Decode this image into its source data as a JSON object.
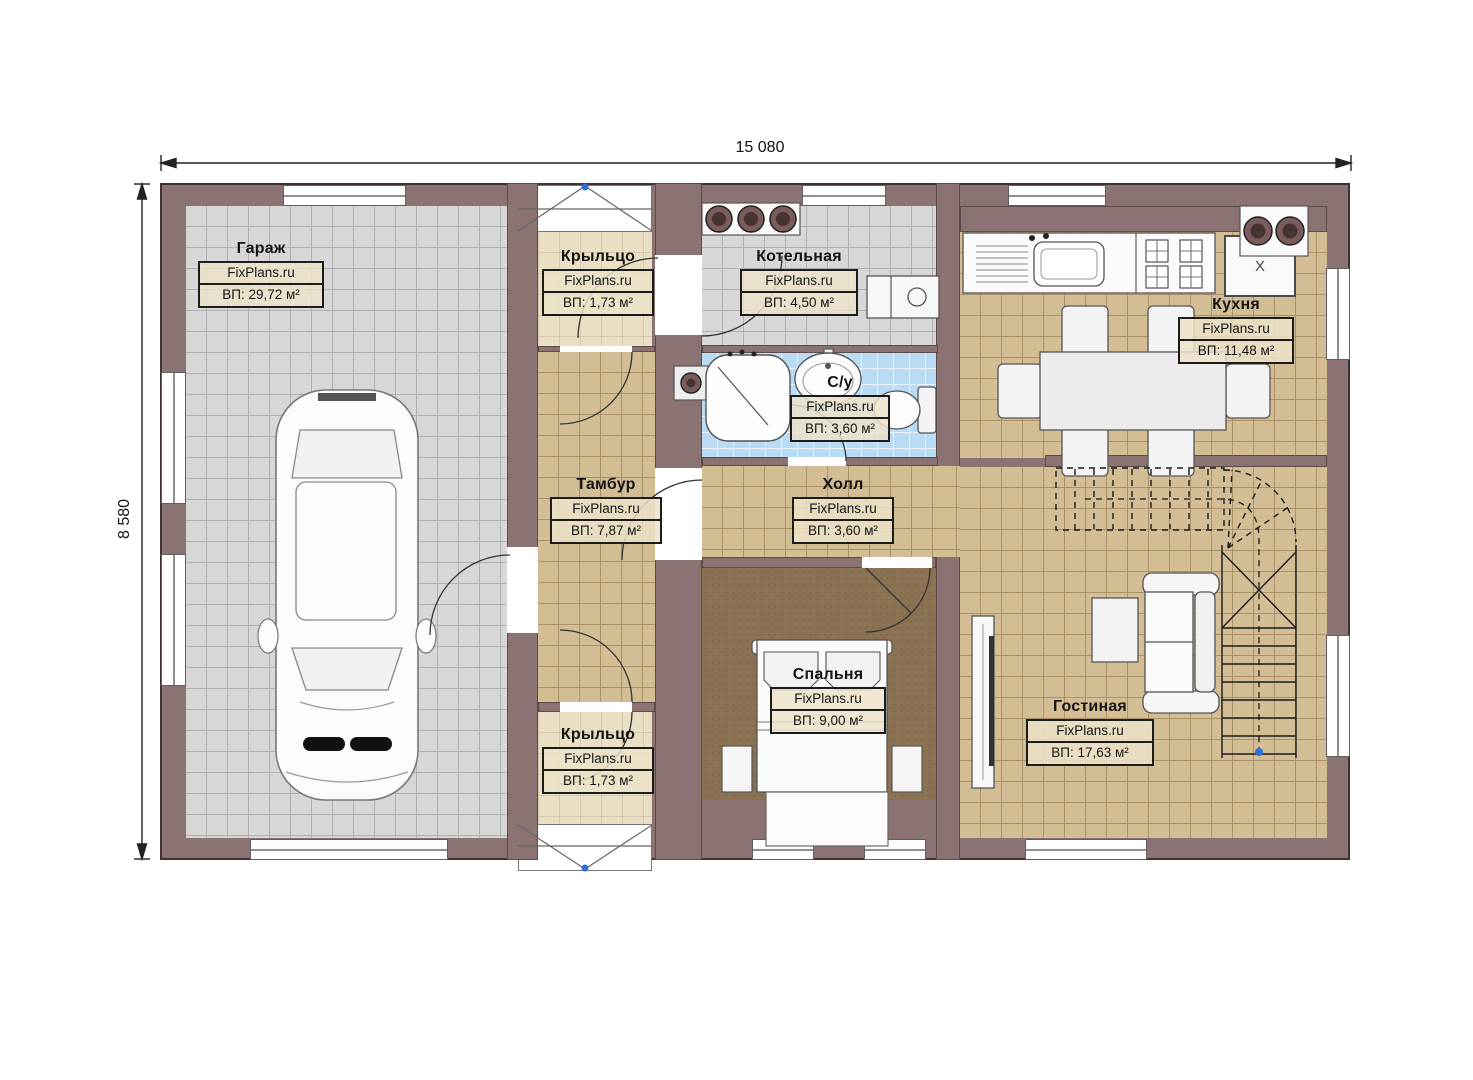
{
  "dimensions": {
    "width_label": "15 080",
    "height_label": "8 580"
  },
  "watermark": "FixPlans.ru",
  "rooms": {
    "garage": {
      "name": "Гараж",
      "watermark": "FixPlans.ru",
      "area": "ВП: 29,72 м²"
    },
    "porch_top": {
      "name": "Крыльцо",
      "watermark": "FixPlans.ru",
      "area": "ВП: 1,73 м²"
    },
    "boiler_room": {
      "name": "Котельная",
      "watermark": "FixPlans.ru",
      "area": "ВП: 4,50 м²"
    },
    "kitchen": {
      "name": "Кухня",
      "watermark": "FixPlans.ru",
      "area": "ВП: 11,48 м²"
    },
    "bathroom": {
      "name": "С/у",
      "watermark": "FixPlans.ru",
      "area": "ВП: 3,60 м²"
    },
    "vestibule": {
      "name": "Тамбур",
      "watermark": "FixPlans.ru",
      "area": "ВП: 7,87 м²"
    },
    "hall": {
      "name": "Холл",
      "watermark": "FixPlans.ru",
      "area": "ВП: 3,60 м²"
    },
    "bedroom": {
      "name": "Спальня",
      "watermark": "FixPlans.ru",
      "area": "ВП: 9,00 м²"
    },
    "living_room": {
      "name": "Гостиная",
      "watermark": "FixPlans.ru",
      "area": "ВП: 17,63 м²"
    },
    "porch_bottom": {
      "name": "Крыльцо",
      "watermark": "FixPlans.ru",
      "area": "ВП: 1,73 м²"
    }
  },
  "appliances": {
    "fridge_label": "X"
  },
  "colors": {
    "wall": "#8c7373",
    "floor_tile_tan": "#d3bd94",
    "floor_tile_gray": "#d7d7d7",
    "bathroom_tile": "#badbf4",
    "bedroom_floor": "#8b7252",
    "porch_floor": "#e9dfc5",
    "marker_blue": "#2e6fd8"
  }
}
